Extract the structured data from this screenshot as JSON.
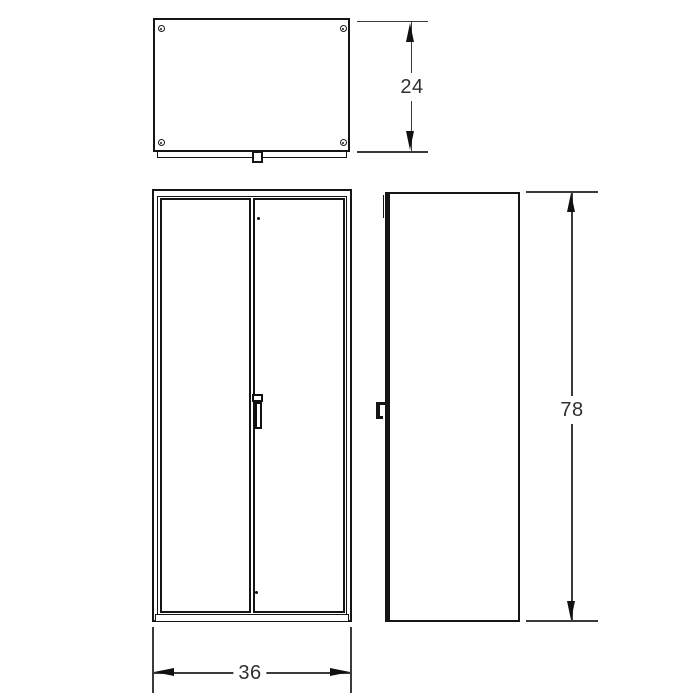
{
  "drawing": {
    "subject": "two-door cabinet orthographic drawing",
    "colors": {
      "background": "#ffffff",
      "object_line": "#151515",
      "dimension_line": "#3a3a3a",
      "text": "#2f2f2f"
    },
    "dimensions": {
      "depth": "24",
      "width": "36",
      "height": "78"
    }
  }
}
